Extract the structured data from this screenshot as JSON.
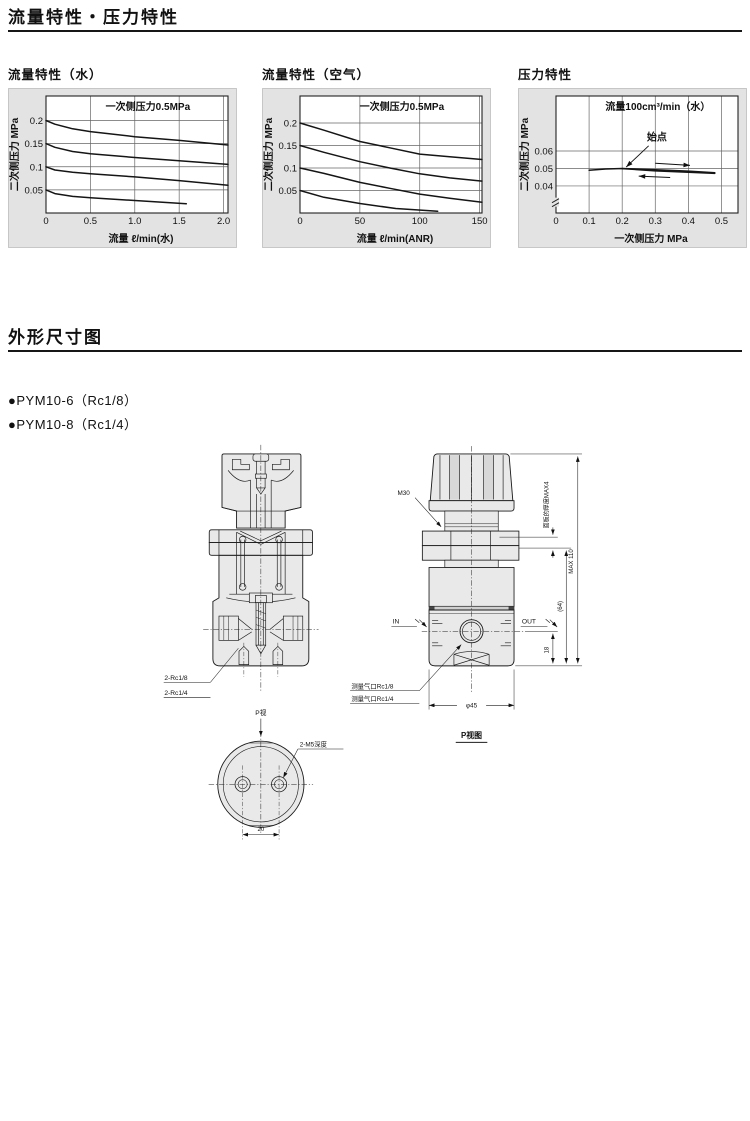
{
  "page": {
    "section1_title": "流量特性・压力特性",
    "section2_title": "外形尺寸图",
    "models": [
      {
        "label": "●PYM10-6（Rc1/8）"
      },
      {
        "label": "●PYM10-8（Rc1/4）"
      }
    ]
  },
  "chart_data": [
    {
      "type": "line",
      "title": "流量特性（水）",
      "inside_label": "一次侧压力0.5MPa",
      "xlabel": "流量 ℓ/min(水)",
      "ylabel": "二次侧压力 MPa",
      "xlim": [
        0,
        2.05
      ],
      "ylim": [
        0,
        0.253
      ],
      "xticks": [
        0,
        0.5,
        1.0,
        1.5,
        2.0
      ],
      "xtick_labels": [
        "0",
        "0.5",
        "1.0",
        "1.5",
        "2.0"
      ],
      "yticks": [
        0.05,
        0.1,
        0.15,
        0.2
      ],
      "ytick_labels": [
        "0.05",
        "0.1",
        "0.15",
        "0.2"
      ],
      "grid": true,
      "legend": "none",
      "series": [
        {
          "name": "设定0.2MPa",
          "x": [
            0,
            0.1,
            0.3,
            0.5,
            1.0,
            1.5,
            2.05
          ],
          "y": [
            0.2,
            0.192,
            0.182,
            0.176,
            0.165,
            0.157,
            0.147
          ]
        },
        {
          "name": "设定0.15MPa",
          "x": [
            0,
            0.1,
            0.3,
            0.5,
            1.0,
            1.5,
            2.05
          ],
          "y": [
            0.15,
            0.142,
            0.133,
            0.128,
            0.12,
            0.113,
            0.105
          ]
        },
        {
          "name": "设定0.1MPa",
          "x": [
            0,
            0.1,
            0.3,
            0.5,
            1.0,
            1.5,
            2.05
          ],
          "y": [
            0.1,
            0.093,
            0.088,
            0.085,
            0.078,
            0.07,
            0.06
          ]
        },
        {
          "name": "设定0.05MPa",
          "x": [
            0,
            0.1,
            0.3,
            0.5,
            1.0,
            1.58
          ],
          "y": [
            0.05,
            0.042,
            0.036,
            0.033,
            0.027,
            0.02
          ]
        }
      ]
    },
    {
      "type": "line",
      "title": "流量特性（空气）",
      "inside_label": "一次侧压力0.5MPa",
      "xlabel": "流量 ℓ/min(ANR)",
      "ylabel": "二次侧压力 MPa",
      "xlim": [
        0,
        152
      ],
      "ylim": [
        0,
        0.26
      ],
      "xticks": [
        0,
        50,
        100,
        150
      ],
      "xtick_labels": [
        "0",
        "50",
        "100",
        "150"
      ],
      "yticks": [
        0.05,
        0.1,
        0.15,
        0.2
      ],
      "ytick_labels": [
        "0.05",
        "0.1",
        "0.15",
        "0.2"
      ],
      "grid": true,
      "legend": "none",
      "series": [
        {
          "name": "设定0.2MPa",
          "x": [
            0,
            20,
            50,
            75,
            100,
            125,
            152
          ],
          "y": [
            0.2,
            0.184,
            0.159,
            0.145,
            0.131,
            0.125,
            0.119
          ]
        },
        {
          "name": "设定0.15MPa",
          "x": [
            0,
            20,
            50,
            75,
            100,
            125,
            152
          ],
          "y": [
            0.15,
            0.135,
            0.114,
            0.1,
            0.087,
            0.078,
            0.071
          ]
        },
        {
          "name": "设定0.1MPa",
          "x": [
            0,
            20,
            50,
            75,
            100,
            125,
            152
          ],
          "y": [
            0.1,
            0.088,
            0.068,
            0.055,
            0.042,
            0.033,
            0.024
          ]
        },
        {
          "name": "设定0.05MPa",
          "x": [
            0,
            20,
            50,
            80,
            115
          ],
          "y": [
            0.05,
            0.035,
            0.021,
            0.01,
            0.004
          ]
        }
      ]
    },
    {
      "type": "line",
      "title": "压力特性",
      "inside_label": "流量100cm³/min（水）",
      "xlabel": "一次侧压力 MPa",
      "ylabel": "二次侧压力 MPa",
      "xlim": [
        0,
        0.55
      ],
      "ylim": [
        0.0245,
        0.0915
      ],
      "xticks": [
        0,
        0.1,
        0.2,
        0.3,
        0.4,
        0.5
      ],
      "xtick_labels": [
        "0",
        "0.1",
        "0.2",
        "0.3",
        "0.4",
        "0.5"
      ],
      "yticks": [
        0.04,
        0.05,
        0.06
      ],
      "ytick_labels": [
        "0.04",
        "0.05",
        "0.06"
      ],
      "grid": true,
      "legend": "none",
      "axis_break_y": 0.031,
      "series": [
        {
          "name": "升压行程",
          "x": [
            0.1,
            0.15,
            0.2,
            0.3,
            0.4,
            0.48
          ],
          "y": [
            0.049,
            0.0497,
            0.05,
            0.0493,
            0.0485,
            0.0476
          ]
        },
        {
          "name": "降压行程",
          "x": [
            0.2,
            0.3,
            0.4,
            0.48
          ],
          "y": [
            0.0499,
            0.0486,
            0.0478,
            0.0472
          ]
        }
      ],
      "annotation_point": {
        "label": "始点",
        "lx": 0.305,
        "ly": 0.066,
        "ax": 0.28,
        "ay": 0.063,
        "px": 0.212,
        "py": 0.0508
      },
      "arrows": [
        {
          "x1": 0.3,
          "y1": 0.053,
          "x2": 0.405,
          "y2": 0.0518
        },
        {
          "x1": 0.345,
          "y1": 0.0448,
          "x2": 0.25,
          "y2": 0.0456
        }
      ]
    }
  ],
  "drawing": {
    "left": {
      "port_label_1": "2-Rc1/8",
      "port_label_2": "2-Rc1/4"
    },
    "pview": {
      "view_label": "P视",
      "thread_label": "2-M5深度",
      "dim_width": "20",
      "view_title": "P视图"
    },
    "right": {
      "thread_label": "M30",
      "inlet": "IN",
      "outlet": "OUT",
      "panel_thickness": "面板的厚度MAX4",
      "overall_height": "MAX 110",
      "body_height": "(64)",
      "port_height": "18",
      "body_diameter": "φ45",
      "gauge_label_1": "测量气口Rc1/8",
      "gauge_label_2": "测量气口Rc1/4"
    }
  }
}
